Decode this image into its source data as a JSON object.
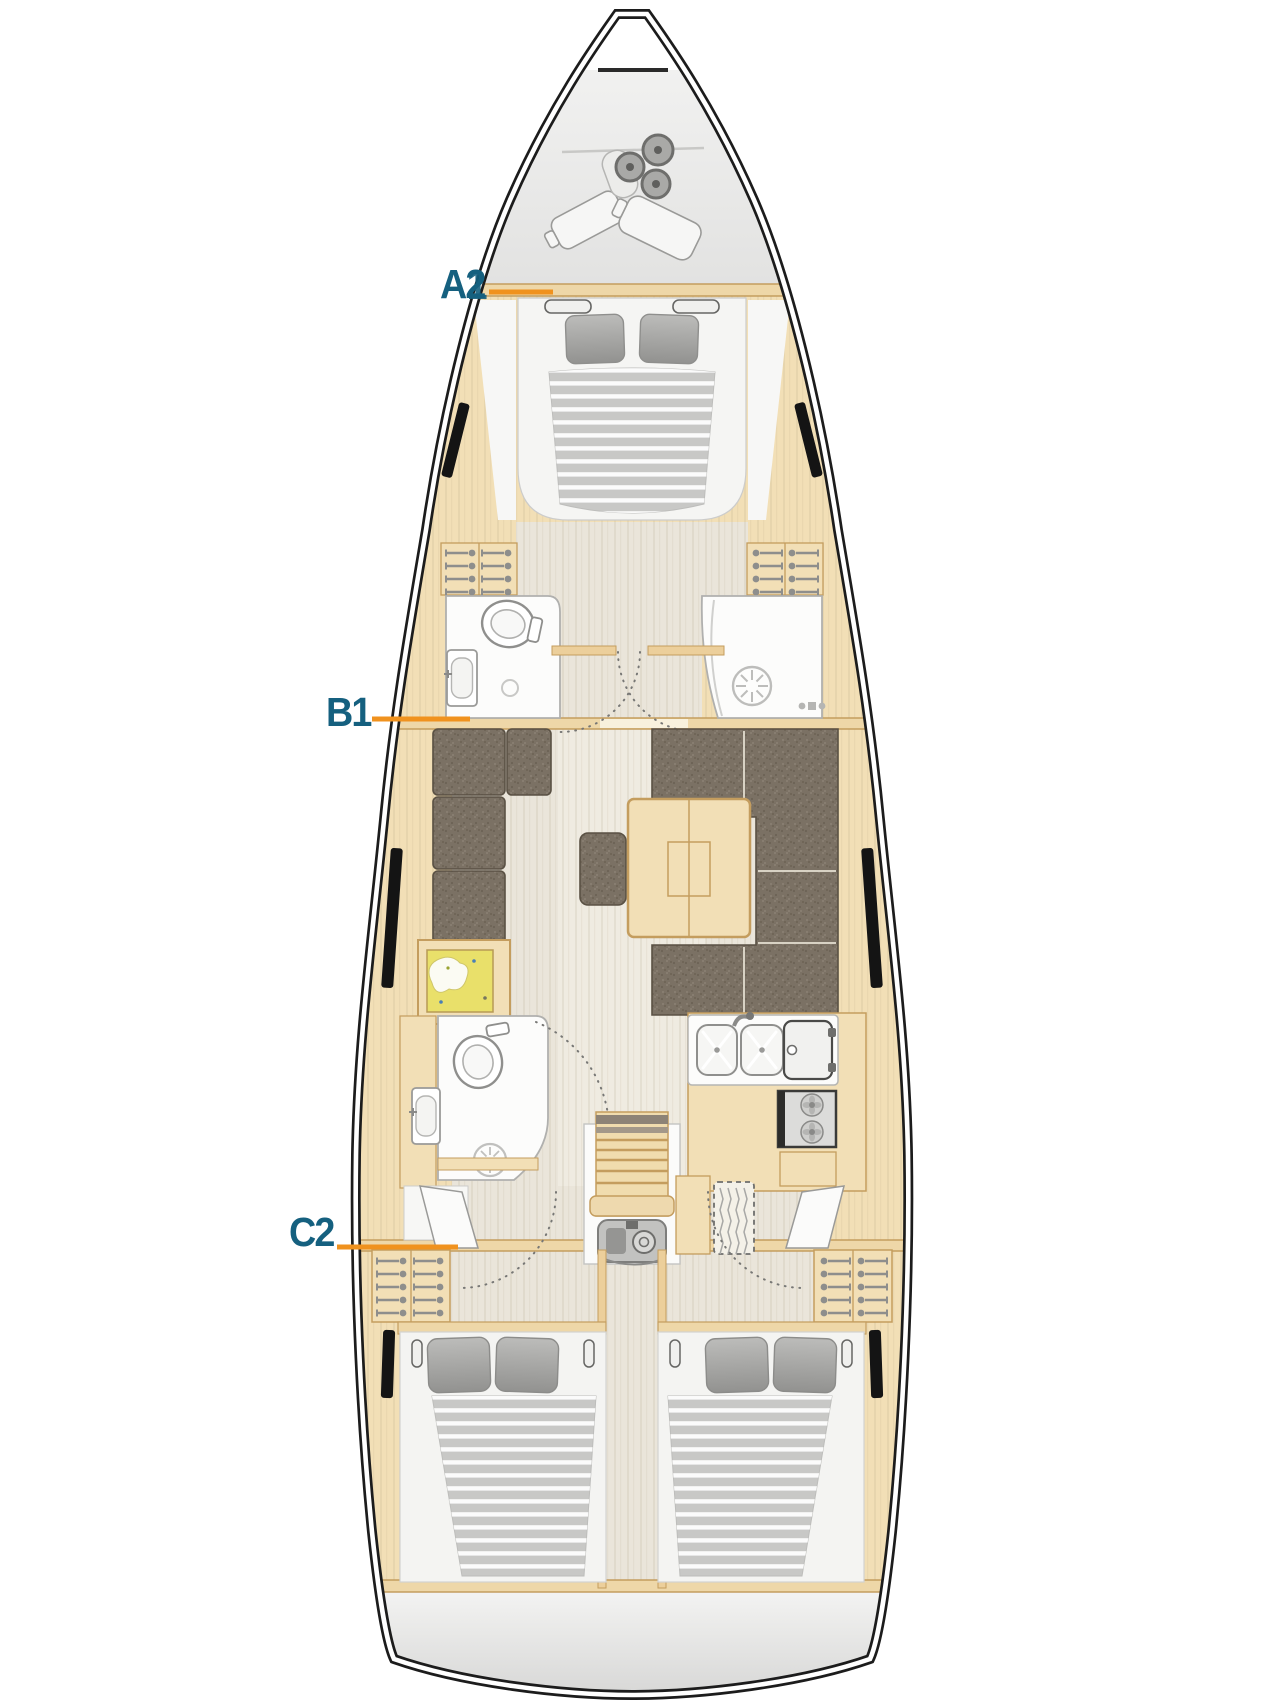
{
  "labels": {
    "cabin_a": {
      "letter": "A",
      "number": "2",
      "overlay_number": "1"
    },
    "cabin_b": {
      "text": "B1"
    },
    "cabin_c": {
      "text": "C2"
    }
  },
  "colors": {
    "label_text": "#15607f",
    "leader_line": "#f0921e",
    "hull_outline": "#1c1c1c",
    "wood_light": "#f2dfb6",
    "wood_trim": "#c49d5e",
    "floor_light": "#eae5da",
    "upholstery_brown": "#7b7164",
    "mattress_gray": "#c8c8c6",
    "pillow_gray": "#a6a6a4",
    "locker_gray": "#ebebea",
    "fixture_white": "#fcfcfb",
    "map_yellow": "#e9e06a"
  }
}
